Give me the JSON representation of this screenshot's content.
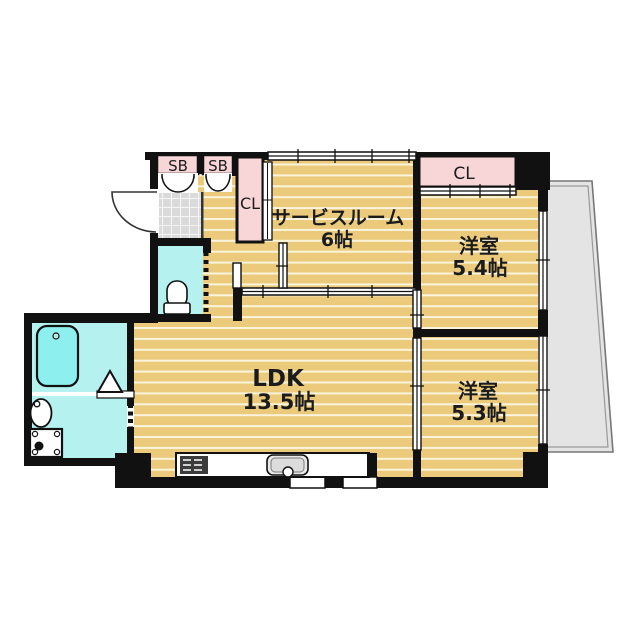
{
  "plan": {
    "type": "apartment-floor-plan",
    "rooms": {
      "service_room": {
        "name": "サービスルーム",
        "area": "6帖"
      },
      "western_room_1": {
        "name": "洋室",
        "area": "5.4帖"
      },
      "western_room_2": {
        "name": "洋室",
        "area": "5.3帖"
      },
      "ldk": {
        "name": "LDK",
        "area": "13.5帖"
      }
    },
    "storage": {
      "shoe_box_1": "SB",
      "shoe_box_2": "SB",
      "closet_hall": "CL",
      "closet_bedroom": "CL"
    },
    "fixtures": [
      "entrance-door",
      "genkan-tile-floor",
      "toilet",
      "bathtub",
      "washbasin",
      "washing-machine-pan",
      "kitchen-stove",
      "kitchen-sink",
      "balcony",
      "sliding-doors",
      "windows"
    ],
    "colors": {
      "floor": "#ebcb7b",
      "floor_line": "#faf4dd",
      "closet_pink": "#f8d6d8",
      "water_cyan": "#b4f1ef",
      "bathtub_cyan": "#8df0ee",
      "entrance_tile": "#dadada",
      "balcony_gray": "#e4e4e4",
      "wall_black": "#111111"
    }
  }
}
